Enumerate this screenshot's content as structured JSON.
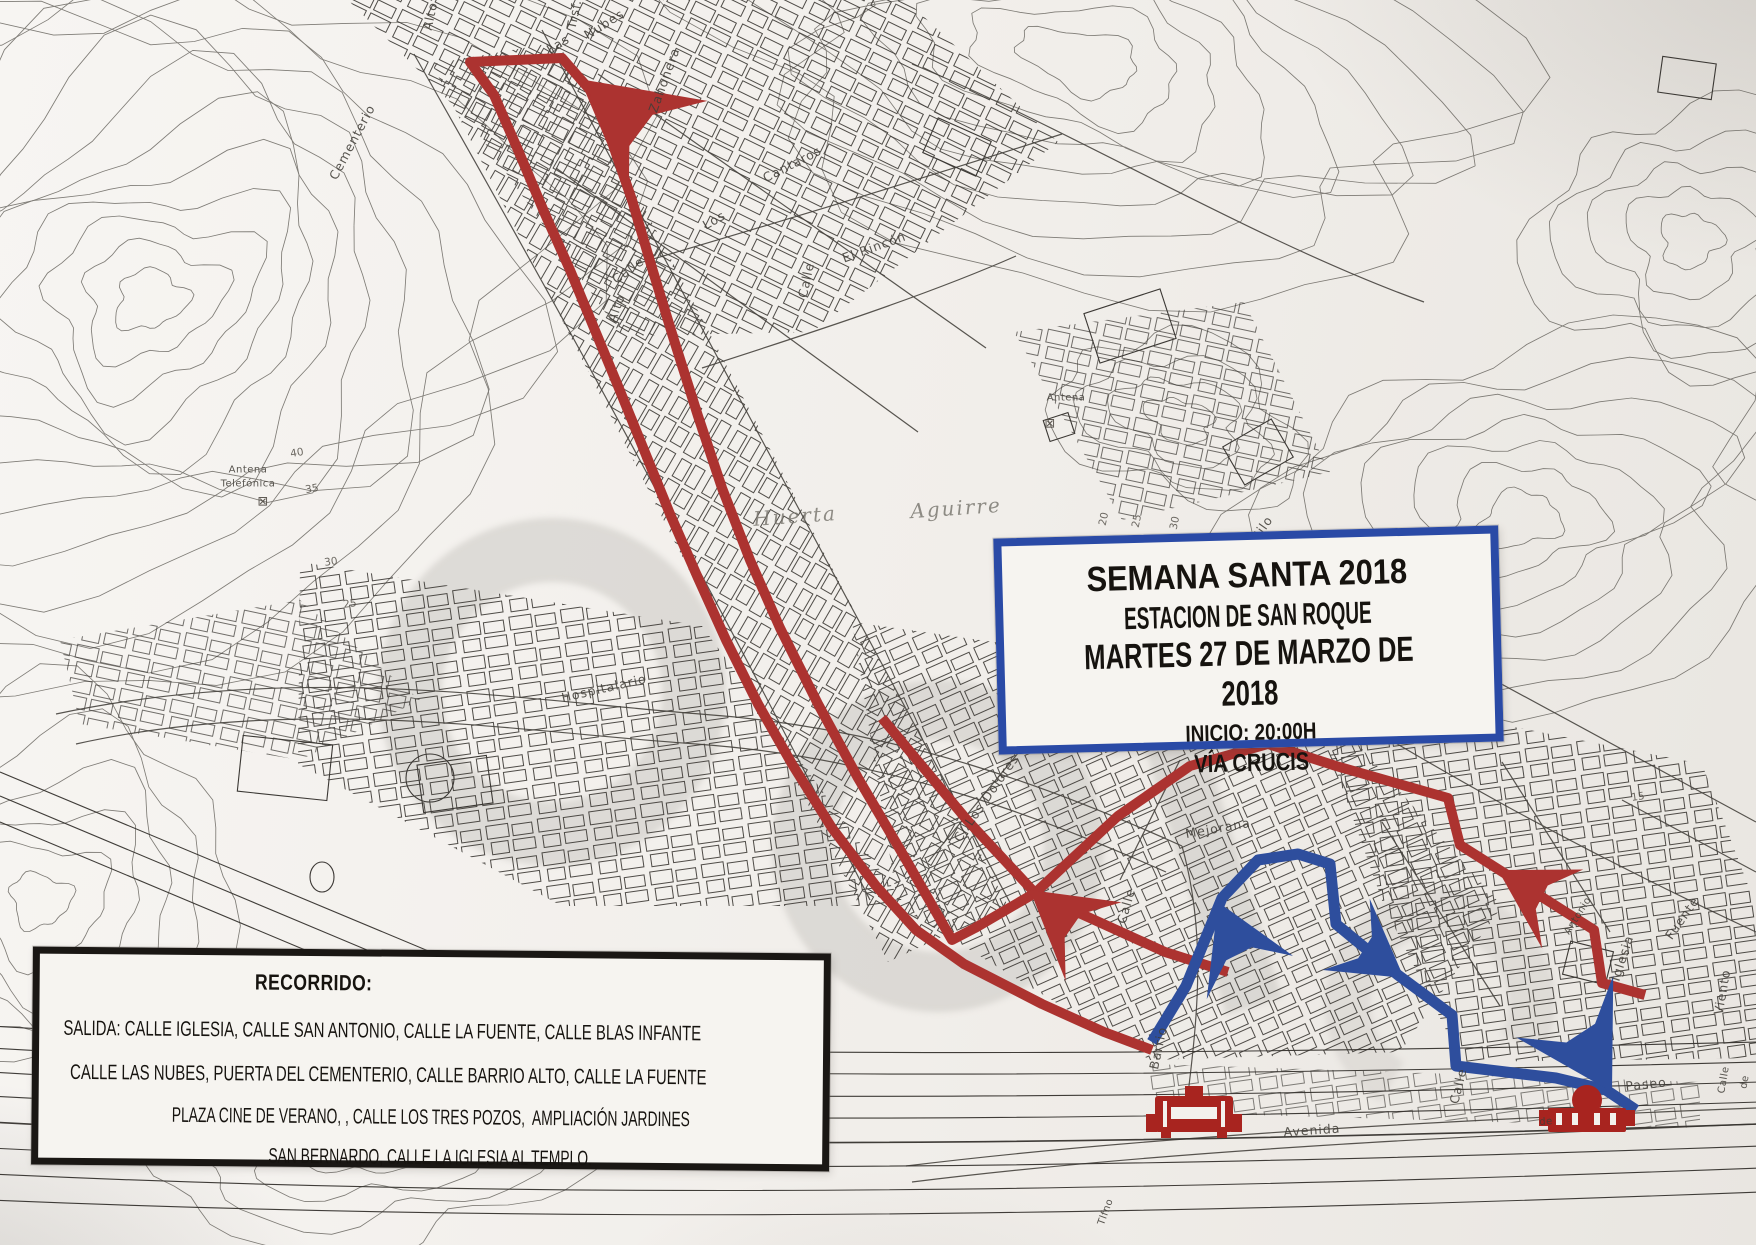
{
  "title_box": {
    "border_color": "#2a4aa6",
    "line1": "SEMANA SANTA 2018",
    "line2": "ESTACION DE SAN ROQUE",
    "line3": "MARTES 27 DE MARZO DE 2018",
    "line4": "INICIO: 20:00H",
    "line5": "VÍA CRUCIS"
  },
  "recorrido_box": {
    "border_color": "#1a1714",
    "title": "RECORRIDO:",
    "lines": [
      "SALIDA: CALLE IGLESIA, CALLE SAN ANTONIO, CALLE LA FUENTE, CALLE BLAS INFANTE",
      "CALLE LAS NUBES, PUERTA DEL CEMENTERIO, CALLE BARRIO ALTO, CALLE LA FUENTE",
      "PLAZA CINE DE VERANO, , CALLE LOS TRES POZOS,  AMPLIACIÓN JARDINES",
      "SAN BERNARDO, CALLE LA IGLESIA AL TEMPLO."
    ]
  },
  "map": {
    "route_red_color": "#ac3330",
    "route_blue_color": "#2e4e9d",
    "marker_color": "#a8241f",
    "icons": [
      {
        "name": "templo-marker-west"
      },
      {
        "name": "templo-marker-east"
      }
    ],
    "routes": {
      "red": {
        "color": "#ac3330",
        "width": 10,
        "paths": [
          {
            "pts": [
              [
                1645,
                995
              ],
              [
                1602,
                983
              ],
              [
                1594,
                930
              ],
              [
                1460,
                845
              ],
              [
                1448,
                798
              ],
              [
                1336,
                766
              ],
              [
                1268,
                744
              ],
              [
                1190,
                766
              ],
              [
                1118,
                816
              ],
              [
                1035,
                893
              ],
              [
                975,
                928
              ],
              [
                952,
                940
              ],
              [
                905,
                858
              ],
              [
                858,
                778
              ],
              [
                818,
                704
              ],
              [
                780,
                628
              ],
              [
                750,
                560
              ],
              [
                722,
                488
              ],
              [
                698,
                416
              ],
              [
                674,
                340
              ],
              [
                652,
                268
              ],
              [
                632,
                200
              ],
              [
                612,
                142
              ],
              [
                590,
                90
              ],
              [
                562,
                58
              ],
              [
                470,
                62
              ],
              [
                494,
                95
              ],
              [
                518,
                150
              ],
              [
                545,
                214
              ],
              [
                570,
                270
              ],
              [
                594,
                328
              ],
              [
                618,
                386
              ],
              [
                644,
                450
              ],
              [
                670,
                514
              ],
              [
                698,
                578
              ],
              [
                726,
                640
              ],
              [
                758,
                704
              ],
              [
                792,
                764
              ],
              [
                832,
                828
              ],
              [
                876,
                886
              ],
              [
                916,
                930
              ],
              [
                964,
                964
              ],
              [
                1042,
                1004
              ],
              [
                1104,
                1032
              ],
              [
                1152,
                1050
              ]
            ]
          },
          {
            "pts": [
              [
                882,
                718
              ],
              [
                967,
                820
              ],
              [
                1035,
                893
              ],
              [
                1165,
                952
              ],
              [
                1228,
                972
              ]
            ]
          }
        ],
        "arrows": [
          {
            "x": 585,
            "y": 80,
            "r": -138,
            "s": 1.75
          },
          {
            "x": 1030,
            "y": 890,
            "r": -140,
            "s": 1.3
          },
          {
            "x": 1498,
            "y": 870,
            "r": -148,
            "s": 1.2
          }
        ]
      },
      "blue": {
        "color": "#2e4e9d",
        "width": 11,
        "paths": [
          {
            "pts": [
              [
                1152,
                1042
              ],
              [
                1186,
                986
              ],
              [
                1222,
                898
              ],
              [
                1258,
                860
              ],
              [
                1298,
                854
              ],
              [
                1330,
                864
              ],
              [
                1336,
                924
              ],
              [
                1398,
                975
              ],
              [
                1452,
                1015
              ],
              [
                1456,
                1066
              ],
              [
                1556,
                1078
              ],
              [
                1606,
                1090
              ],
              [
                1636,
                1110
              ]
            ]
          }
        ],
        "arrows": [
          {
            "x": 1218,
            "y": 902,
            "r": -112,
            "s": 1.3
          },
          {
            "x": 1404,
            "y": 978,
            "r": 38,
            "s": 1.15
          },
          {
            "x": 1612,
            "y": 1092,
            "r": 62,
            "s": 1.55
          }
        ]
      }
    },
    "labels": [
      {
        "t": "Alto",
        "x": 430,
        "y": 16,
        "r": -78
      },
      {
        "t": "Trsf.",
        "x": 574,
        "y": 14,
        "r": -78
      },
      {
        "t": "Las",
        "x": 558,
        "y": 44,
        "r": -32
      },
      {
        "t": "Nubes",
        "x": 604,
        "y": 24,
        "r": -32
      },
      {
        "t": "Cementerio",
        "x": 352,
        "y": 142,
        "r": -62
      },
      {
        "t": "Zahonera",
        "x": 664,
        "y": 80,
        "r": -70
      },
      {
        "t": "Cantaros",
        "x": 792,
        "y": 164,
        "r": -27
      },
      {
        "t": "Los",
        "x": 714,
        "y": 220,
        "r": -30
      },
      {
        "t": "Calle",
        "x": 628,
        "y": 270,
        "r": -36
      },
      {
        "t": "El Rincón",
        "x": 874,
        "y": 247,
        "r": -20
      },
      {
        "t": "Calle",
        "x": 806,
        "y": 280,
        "r": -78
      },
      {
        "t": "Alto",
        "x": 616,
        "y": 308,
        "r": -70
      },
      {
        "t": "Huerta",
        "x": 795,
        "y": 516,
        "r": -4,
        "cls": "it"
      },
      {
        "t": "Aguirre",
        "x": 956,
        "y": 508,
        "r": -4,
        "cls": "it"
      },
      {
        "t": "Antena",
        "x": 1066,
        "y": 398,
        "r": 0,
        "cls": "sm"
      },
      {
        "t": "⊠",
        "x": 1050,
        "y": 424,
        "r": 0,
        "cls": "sym"
      },
      {
        "t": "Antena",
        "x": 248,
        "y": 470,
        "r": 0,
        "cls": "sm"
      },
      {
        "t": "Telefónica",
        "x": 248,
        "y": 484,
        "r": 0,
        "cls": "sm"
      },
      {
        "t": "⊠",
        "x": 263,
        "y": 502,
        "r": 0,
        "cls": "sym"
      },
      {
        "t": "Silo",
        "x": 1262,
        "y": 528,
        "r": -55
      },
      {
        "t": "20",
        "x": 1104,
        "y": 519,
        "r": -78,
        "cls": "num"
      },
      {
        "t": "25",
        "x": 1137,
        "y": 521,
        "r": -78,
        "cls": "num"
      },
      {
        "t": "30",
        "x": 1175,
        "y": 523,
        "r": -78,
        "cls": "num"
      },
      {
        "t": "Hospitalario",
        "x": 604,
        "y": 688,
        "r": -13
      },
      {
        "t": "C/ Los Dolores",
        "x": 986,
        "y": 798,
        "r": -55
      },
      {
        "t": "Mejorana",
        "x": 1218,
        "y": 828,
        "r": -10
      },
      {
        "t": "Calle",
        "x": 1126,
        "y": 906,
        "r": -74
      },
      {
        "t": "Antonio",
        "x": 1578,
        "y": 916,
        "r": -58,
        "cls": "sm"
      },
      {
        "t": "Iglesia",
        "x": 1622,
        "y": 958,
        "r": -72
      },
      {
        "t": "Fuente",
        "x": 1682,
        "y": 918,
        "r": -55
      },
      {
        "t": "Barrio",
        "x": 1158,
        "y": 1048,
        "r": -78
      },
      {
        "t": "Paseo",
        "x": 1646,
        "y": 1084,
        "r": -6
      },
      {
        "t": "Avenida",
        "x": 1312,
        "y": 1130,
        "r": -4
      },
      {
        "t": "de",
        "x": 1546,
        "y": 1122,
        "r": -4,
        "cls": "sm"
      },
      {
        "t": "Calle",
        "x": 1458,
        "y": 1086,
        "r": -76
      },
      {
        "t": "Viento",
        "x": 1722,
        "y": 992,
        "r": -80
      },
      {
        "t": "Calle",
        "x": 1724,
        "y": 1080,
        "r": -80,
        "cls": "sm"
      },
      {
        "t": "de",
        "x": 1745,
        "y": 1082,
        "r": -80,
        "cls": "sm"
      },
      {
        "t": "Tlfno",
        "x": 1106,
        "y": 1212,
        "r": -70,
        "cls": "sm"
      },
      {
        "t": "40",
        "x": 297,
        "y": 453,
        "r": -10,
        "cls": "num"
      },
      {
        "t": "35",
        "x": 312,
        "y": 489,
        "r": -10,
        "cls": "num"
      },
      {
        "t": "30",
        "x": 331,
        "y": 562,
        "r": -8,
        "cls": "num"
      },
      {
        "t": "25",
        "x": 350,
        "y": 604,
        "r": -8,
        "cls": "num"
      },
      {
        "t": "15",
        "x": 1638,
        "y": 797,
        "r": -8,
        "cls": "num"
      }
    ]
  }
}
